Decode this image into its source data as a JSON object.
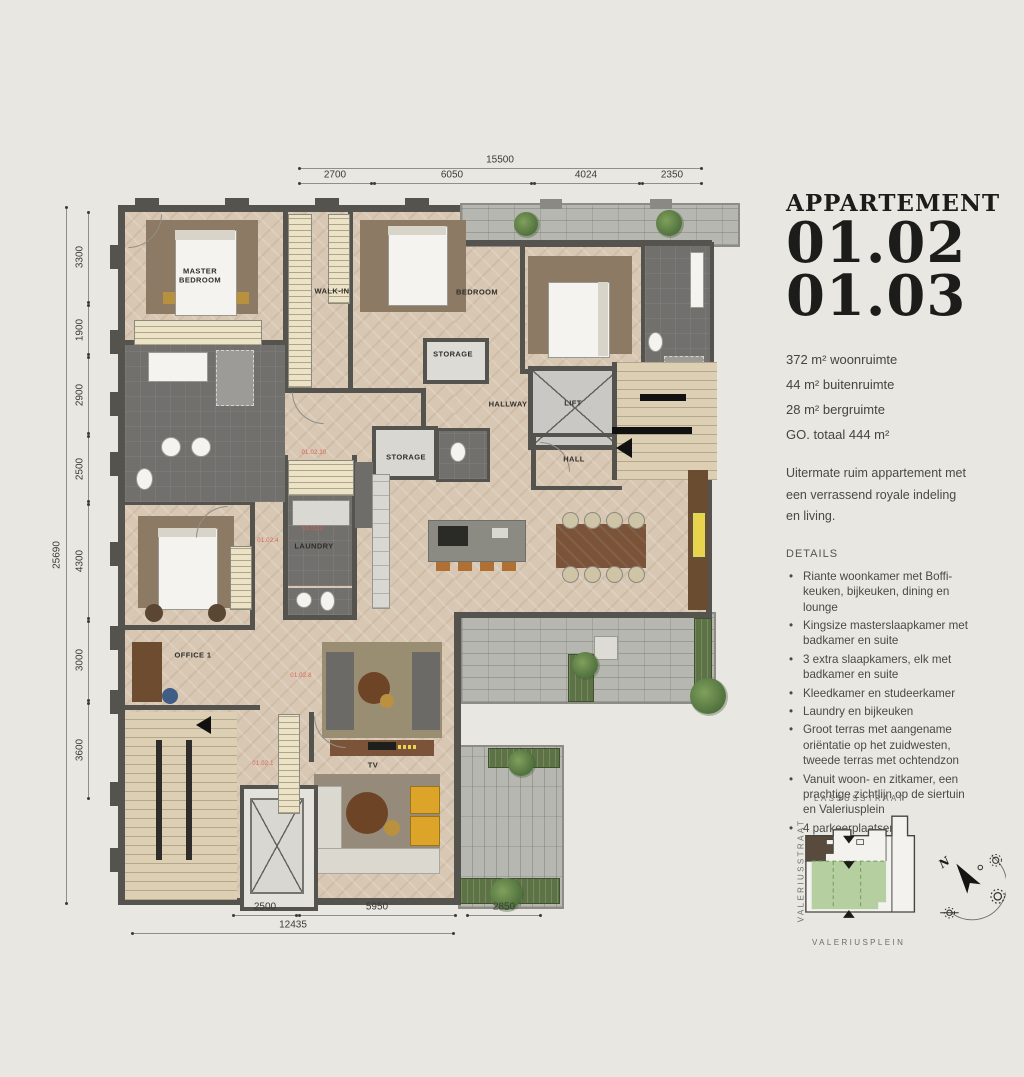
{
  "page": {
    "background": "#e9e7e2"
  },
  "panel": {
    "title": "APPARTEMENT",
    "unit_numbers": [
      "01.02",
      "01.03"
    ],
    "stats": [
      "372 m² woonruimte",
      "44 m² buitenruimte",
      "28 m² bergruimte",
      "GO. totaal  444 m²"
    ],
    "intro": "Uitermate ruim appartement met een verrassend royale indeling en living.",
    "details_heading": "DETAILS",
    "details": [
      "Riante woonkamer met Boffi-keuken, bijkeuken, dining en lounge",
      "Kingsize masterslaapkamer met badkamer en suite",
      "3 extra slaapkamers, elk met badkamer en suite",
      "Kleedkamer en studeerkamer",
      "Laundry en bijkeuken",
      "Groot terras met aangename oriëntatie op het zuidwesten, tweede terras met ochtendzon",
      "Vanuit woon- en zitkamer, een prachtige zichtlijn op de siertuin en Valeriusplein",
      "4 parkeerplaatsen"
    ]
  },
  "plan": {
    "room_labels": [
      {
        "text": "MASTER BEDROOM",
        "x": 200,
        "y": 276,
        "w": 66
      },
      {
        "text": "WALK-IN",
        "x": 332,
        "y": 291
      },
      {
        "text": "BEDROOM",
        "x": 477,
        "y": 292
      },
      {
        "text": "STORAGE",
        "x": 453,
        "y": 354
      },
      {
        "text": "HALLWAY",
        "x": 508,
        "y": 404
      },
      {
        "text": "LIFT",
        "x": 573,
        "y": 403
      },
      {
        "text": "HALL",
        "x": 574,
        "y": 459
      },
      {
        "text": "STORAGE",
        "x": 406,
        "y": 457
      },
      {
        "text": "LAUNDRY",
        "x": 314,
        "y": 546
      },
      {
        "text": "OFFICE 1",
        "x": 193,
        "y": 655
      },
      {
        "text": "TV",
        "x": 373,
        "y": 765
      }
    ],
    "unit_labels": [
      {
        "text": "01.02.10",
        "x": 314,
        "y": 453
      },
      {
        "text": "01.02.2",
        "x": 313,
        "y": 529
      },
      {
        "text": "01.02.4",
        "x": 268,
        "y": 541
      },
      {
        "text": "01.02.8",
        "x": 301,
        "y": 676
      },
      {
        "text": "01.02.1",
        "x": 263,
        "y": 764
      }
    ],
    "dimensions": [
      {
        "label": "15500",
        "x1": 299,
        "y1": 168,
        "x2": 701,
        "y2": 168,
        "lx": 500,
        "ly": 160
      },
      {
        "label": "2700",
        "x1": 299,
        "y1": 183,
        "x2": 371,
        "y2": 183,
        "lx": 335,
        "ly": 175
      },
      {
        "label": "6050",
        "x1": 374,
        "y1": 183,
        "x2": 531,
        "y2": 183,
        "lx": 452,
        "ly": 175
      },
      {
        "label": "4024",
        "x1": 534,
        "y1": 183,
        "x2": 639,
        "y2": 183,
        "lx": 586,
        "ly": 175
      },
      {
        "label": "2350",
        "x1": 642,
        "y1": 183,
        "x2": 701,
        "y2": 183,
        "lx": 672,
        "ly": 175
      },
      {
        "label": "25690",
        "x1": 66,
        "y1": 207,
        "x2": 66,
        "y2": 903,
        "lx": 57,
        "ly": 555,
        "rot": true
      },
      {
        "label": "3300",
        "x1": 88,
        "y1": 212,
        "x2": 88,
        "y2": 302,
        "lx": 80,
        "ly": 257,
        "rot": true
      },
      {
        "label": "1900",
        "x1": 88,
        "y1": 305,
        "x2": 88,
        "y2": 354,
        "lx": 80,
        "ly": 330,
        "rot": true
      },
      {
        "label": "2900",
        "x1": 88,
        "y1": 357,
        "x2": 88,
        "y2": 433,
        "lx": 80,
        "ly": 395,
        "rot": true
      },
      {
        "label": "2500",
        "x1": 88,
        "y1": 436,
        "x2": 88,
        "y2": 501,
        "lx": 80,
        "ly": 469,
        "rot": true
      },
      {
        "label": "4300",
        "x1": 88,
        "y1": 504,
        "x2": 88,
        "y2": 618,
        "lx": 80,
        "ly": 561,
        "rot": true
      },
      {
        "label": "3000",
        "x1": 88,
        "y1": 621,
        "x2": 88,
        "y2": 700,
        "lx": 80,
        "ly": 660,
        "rot": true
      },
      {
        "label": "3600",
        "x1": 88,
        "y1": 703,
        "x2": 88,
        "y2": 798,
        "lx": 80,
        "ly": 750,
        "rot": true
      },
      {
        "label": "2500",
        "x1": 233,
        "y1": 915,
        "x2": 296,
        "y2": 915,
        "lx": 265,
        "ly": 907
      },
      {
        "label": "5950",
        "x1": 299,
        "y1": 915,
        "x2": 455,
        "y2": 915,
        "lx": 377,
        "ly": 907
      },
      {
        "label": "2850",
        "x1": 467,
        "y1": 915,
        "x2": 540,
        "y2": 915,
        "lx": 504,
        "ly": 907
      },
      {
        "label": "12435",
        "x1": 132,
        "y1": 933,
        "x2": 453,
        "y2": 933,
        "lx": 293,
        "ly": 925
      }
    ]
  },
  "map": {
    "street_top": "LASSUSSTRAAT",
    "street_left": "VALERIUSSTRAAT",
    "street_bottom": "VALERIUSPLEIN",
    "compass_north": "N"
  }
}
